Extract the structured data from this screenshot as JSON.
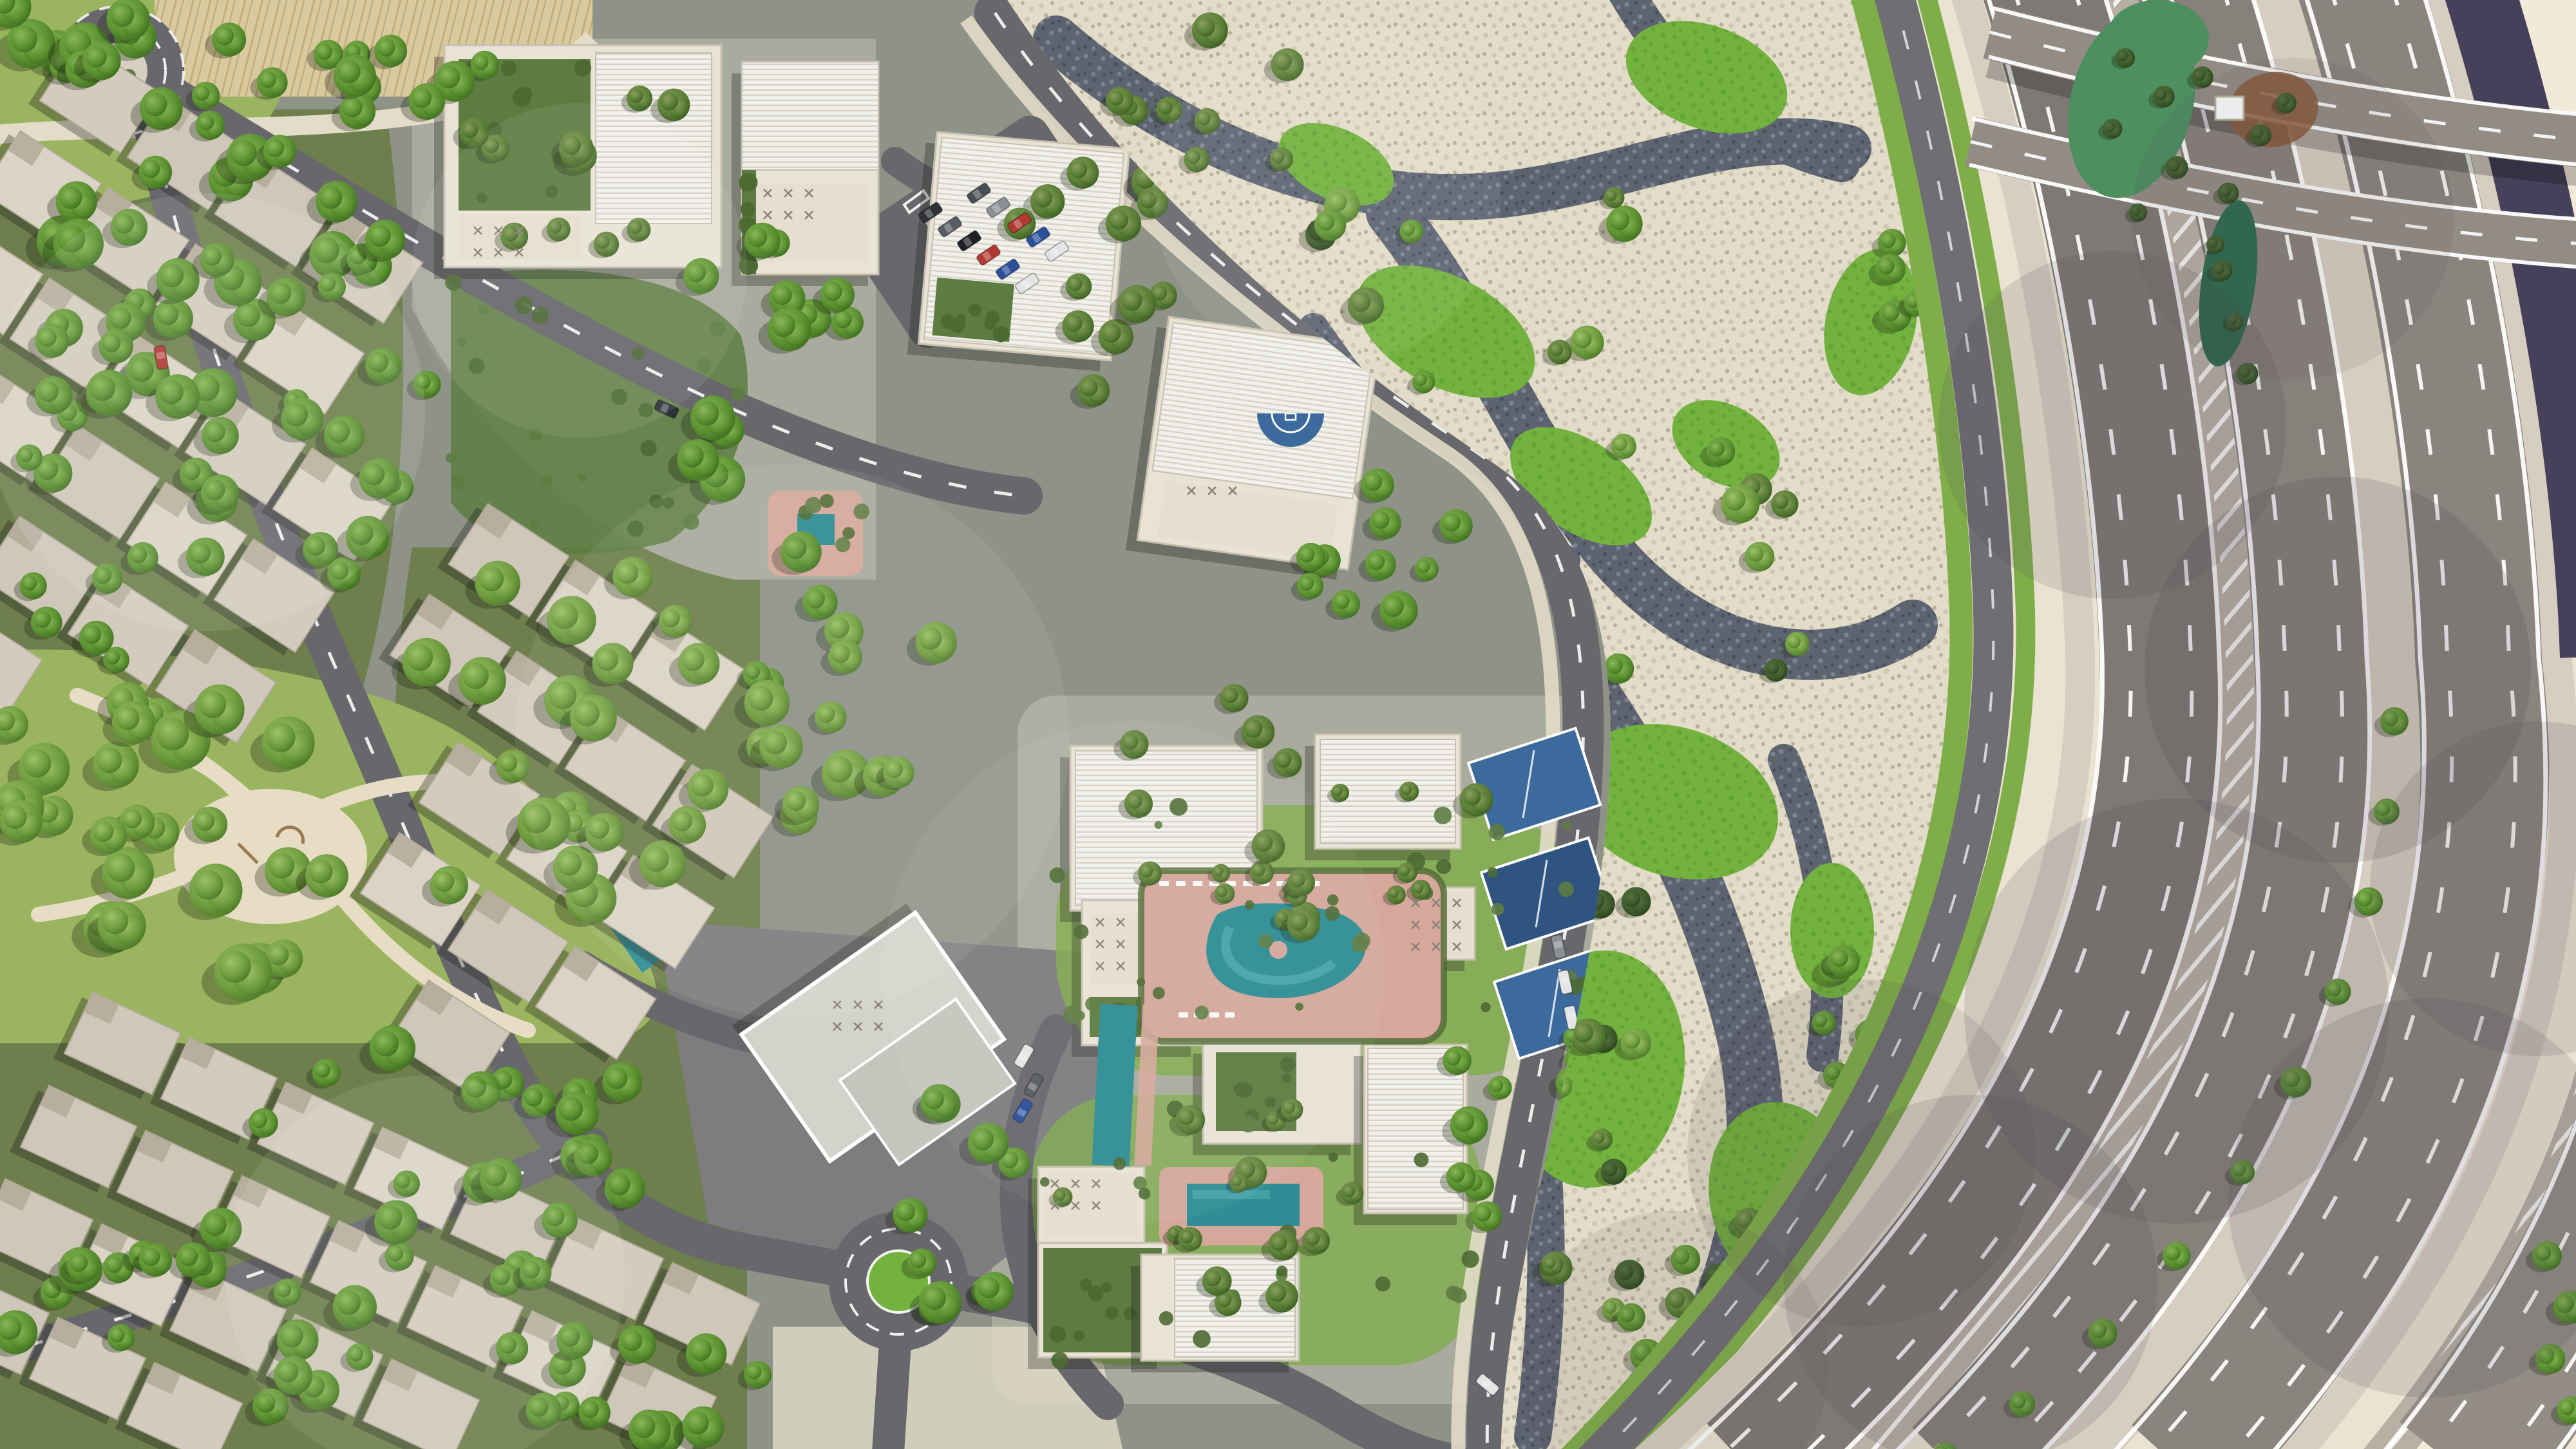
{
  "scene": {
    "title": "Aerial master-plan rendering of a desert residential community",
    "description": "Top-down photorealistic CGI site plan: a townhouse/villa neighborhood and apartment clusters with rooftop louvers, gardens and swimming pools on the left; a landscaped dry-river wadi park of cream gravel, dark pebble beds and grass in the middle; a sweeping multi-lane motorway interchange over open desert sand on the right; large translucent dotted circles overlay the image."
  },
  "legend": {
    "villa_district": "Townhouse and villa neighborhood with tree-lined streets",
    "central_park": "Community park with playground and winding paths",
    "north_cluster": "Apartment cluster with roof gardens, courtyard pool and parking",
    "central_cluster": "Apartment cluster with free-form pool, sun deck and padel courts",
    "south_cluster": "Apartment cluster with lap pool and roof terraces",
    "clubhouse": "Angular-roof clubhouse / sales center with pool",
    "wadi_park": "Wadi landscape: cream gravel, dark pebble streams, grass mounds",
    "service_road": "Tree-lined service road between wadi and motorway",
    "highway": "Curved multi-lane motorway with chevron gores and tree median",
    "overpass": "Overpass ramps crossing the motorway at top right",
    "desert": "Open desert sand with utility road",
    "desert_park": "Small desert park with dark green planting",
    "roundabout_north": "Landscaped roundabout, north-west",
    "roundabout_south": "Landscaped roundabout, south-center",
    "basketball_court": "Blue half basketball court",
    "watermark": "Translucent dotted watermark circles"
  },
  "inventory": {
    "apartment_buildings": 11,
    "villa_roofs_approx": 57,
    "swimming_pools": 5,
    "padel_courts": 3,
    "basketball_half_courts": 1,
    "roundabouts": 2,
    "parked_cars_approx": 28,
    "motorway_carriageways": 4
  },
  "palette": {
    "sand": "#ebe3d2",
    "sand_light": "#f1ead9",
    "dev_ground": "#8e9287",
    "plaza": "#a8ab9d",
    "apron": "#7d7d80",
    "road": "#67676c",
    "service_road": "#6f6e72",
    "highway_1": "#7e7974",
    "highway_2": "#87817b",
    "highway_3": "#8a847e",
    "highway_4": "#928c85",
    "shoulder": "#d6cec0",
    "gore": "#b8b0a4",
    "marking": "#ffffff",
    "gravel": "#e2dcc8",
    "gravel_dot1": "#cfc8b2",
    "gravel_dot2": "#b8b09a",
    "pebble": "#5d6470",
    "pebble_dot1": "#7b8492",
    "pebble_dot2": "#49505c",
    "grass": "#74b23f",
    "grass_dark": "#63a434",
    "verge": "#7fae49",
    "park_grass": "#9ab45f",
    "playground": "#e7ddc5",
    "villa_zone": "#6e7f4d",
    "villa_roof": "#d7d0c2",
    "villa_roof_edge": "#b3ab9b",
    "building_wall": "#e9e3d6",
    "building_edge": "#c7c0b0",
    "louver": "#f2f0ea",
    "louver_line": "#d6d3c9",
    "terrace": "#e6dfcf",
    "furniture": "#8a8278",
    "garden": "#5d7c42",
    "shrub": "#4d6a33",
    "pool": "#2e8d95",
    "pool_light": "#4da9ae",
    "deck": "#d5a89b",
    "court_blue": "#3c6a9c",
    "court_blue_dark": "#2f5480",
    "purple_road": "#46405a",
    "reeds": "#d9c99f",
    "reeds_line": "#c2ad7c",
    "desert_green": "#2e6b4f",
    "desert_green2": "#4e8f5f",
    "rust": "#8a5a3c",
    "shadow": "rgba(30,30,26,0.32)",
    "wm_light": "#ffffff",
    "wm_dark": "#4a444e",
    "trees": {
      "A": [
        "#9cc268",
        "#6f9c3f",
        "#4a7527"
      ],
      "B": [
        "#8ab757",
        "#5c9231",
        "#3c6a1e"
      ],
      "C": [
        "#8aa05c",
        "#5a7f36",
        "#3a5c22"
      ],
      "D": [
        "#55713f",
        "#3f5c2c",
        "#26401a"
      ]
    },
    "cars": [
      "#2e3138",
      "#585c63",
      "#1f2126",
      "#b23832",
      "#2c4f9c",
      "#e3e4e6",
      "#4a4e55",
      "#8b9097",
      "#23303f",
      "#cfd2d6"
    ]
  }
}
